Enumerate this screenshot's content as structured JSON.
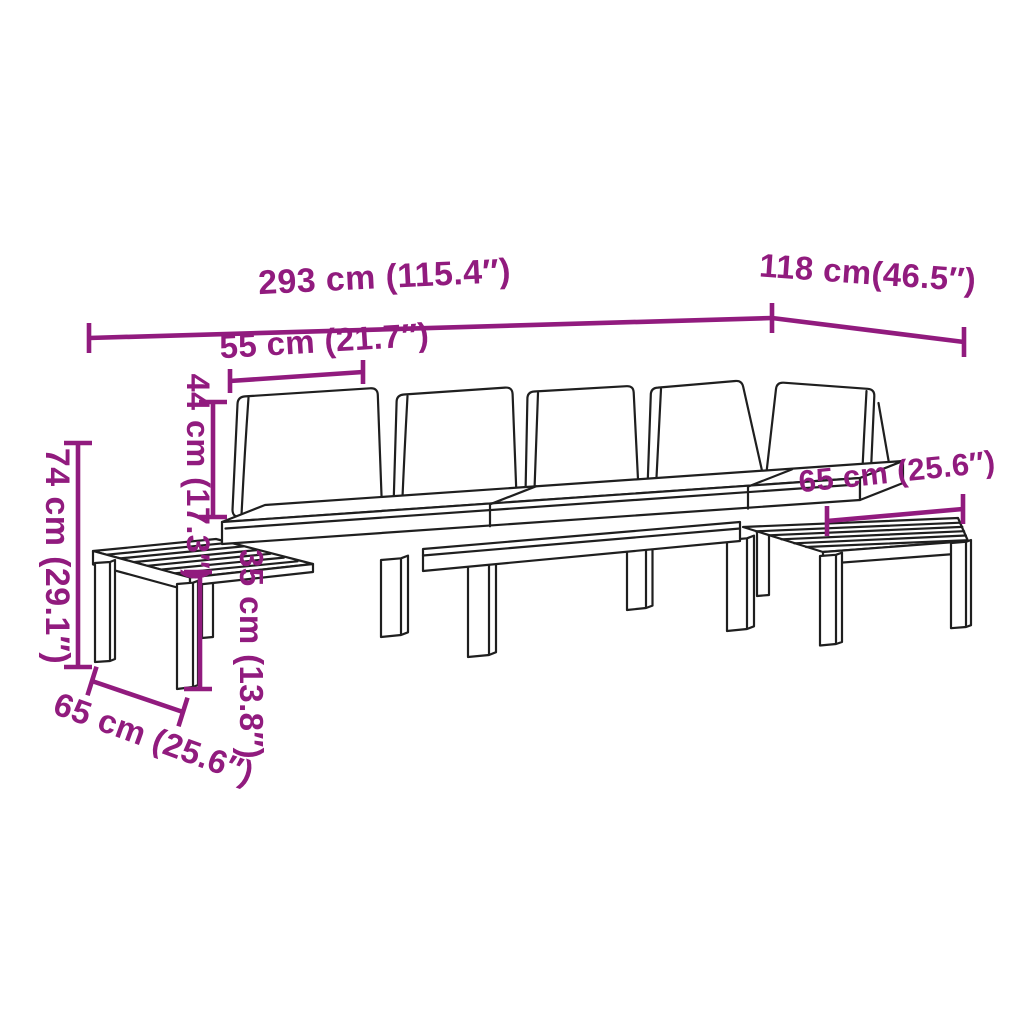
{
  "colors": {
    "accent": "#911B7E",
    "line_art": "#1F1F1F",
    "background": "#FFFFFF"
  },
  "diagram": {
    "labels": {
      "total_width": "293 cm (115.4″)",
      "total_depth": "118 cm(46.5″)",
      "cushion_width": "55 cm (21.7″)",
      "backrest_height": "44 cm (17.3″)",
      "overall_height": "74 cm (29.1″)",
      "table_height": "35 cm (13.8″)",
      "right_table_width": "65 cm (25.6″)",
      "left_table_depth": "65 cm (25.6″)"
    }
  }
}
